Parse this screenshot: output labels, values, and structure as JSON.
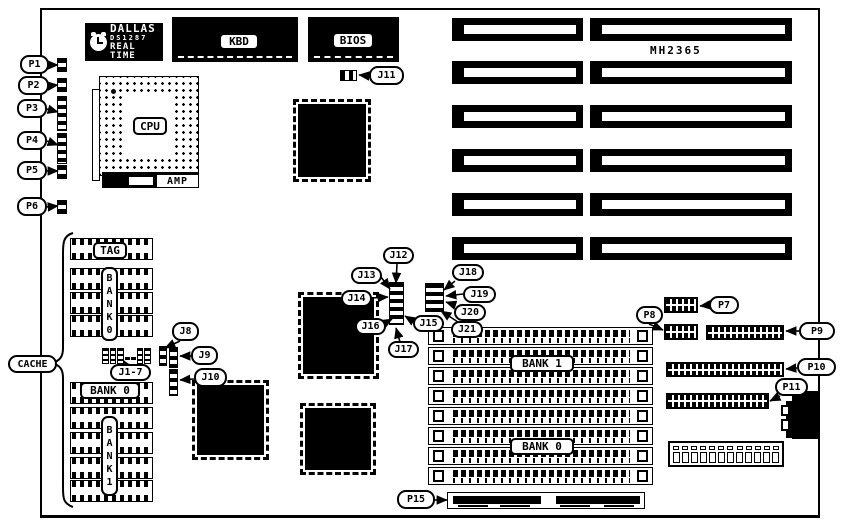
{
  "board": {
    "part_number": "MH2365"
  },
  "chips": {
    "rtc": {
      "brand": "DALLAS",
      "model": "DS1287",
      "type": "REAL TIME"
    },
    "keyboard_controller": "KBD",
    "bios": "BIOS",
    "cpu": "CPU",
    "amp": "AMP"
  },
  "cache": {
    "tag": "TAG",
    "bank0_vertical": "B\nA\nN\nK\n0",
    "bank0_horizontal": "BANK 0",
    "bank1_vertical": "B\nA\nN\nK\n1"
  },
  "memory": {
    "bank1": "BANK 1",
    "bank0": "BANK 0"
  },
  "callouts": [
    {
      "id": "p1",
      "label": "P1"
    },
    {
      "id": "p2",
      "label": "P2"
    },
    {
      "id": "p3",
      "label": "P3"
    },
    {
      "id": "p4",
      "label": "P4"
    },
    {
      "id": "p5",
      "label": "P5"
    },
    {
      "id": "p6",
      "label": "P6"
    },
    {
      "id": "j11",
      "label": "J11"
    },
    {
      "id": "j12",
      "label": "J12"
    },
    {
      "id": "j13",
      "label": "J13"
    },
    {
      "id": "j14",
      "label": "J14"
    },
    {
      "id": "j16",
      "label": "J16"
    },
    {
      "id": "j17",
      "label": "J17"
    },
    {
      "id": "j15",
      "label": "J15"
    },
    {
      "id": "j18",
      "label": "J18"
    },
    {
      "id": "j19",
      "label": "J19"
    },
    {
      "id": "j20",
      "label": "J20"
    },
    {
      "id": "j21",
      "label": "J21"
    },
    {
      "id": "j8",
      "label": "J8"
    },
    {
      "id": "j9",
      "label": "J9"
    },
    {
      "id": "j10",
      "label": "J10"
    },
    {
      "id": "j1_7",
      "label": "J1-7"
    },
    {
      "id": "cache",
      "label": "CACHE"
    },
    {
      "id": "p7",
      "label": "P7"
    },
    {
      "id": "p8",
      "label": "P8"
    },
    {
      "id": "p9",
      "label": "P9"
    },
    {
      "id": "p10",
      "label": "P10"
    },
    {
      "id": "p11",
      "label": "P11"
    },
    {
      "id": "p15",
      "label": "P15"
    }
  ],
  "colors": {
    "ink": "#000000",
    "paper": "#ffffff"
  }
}
